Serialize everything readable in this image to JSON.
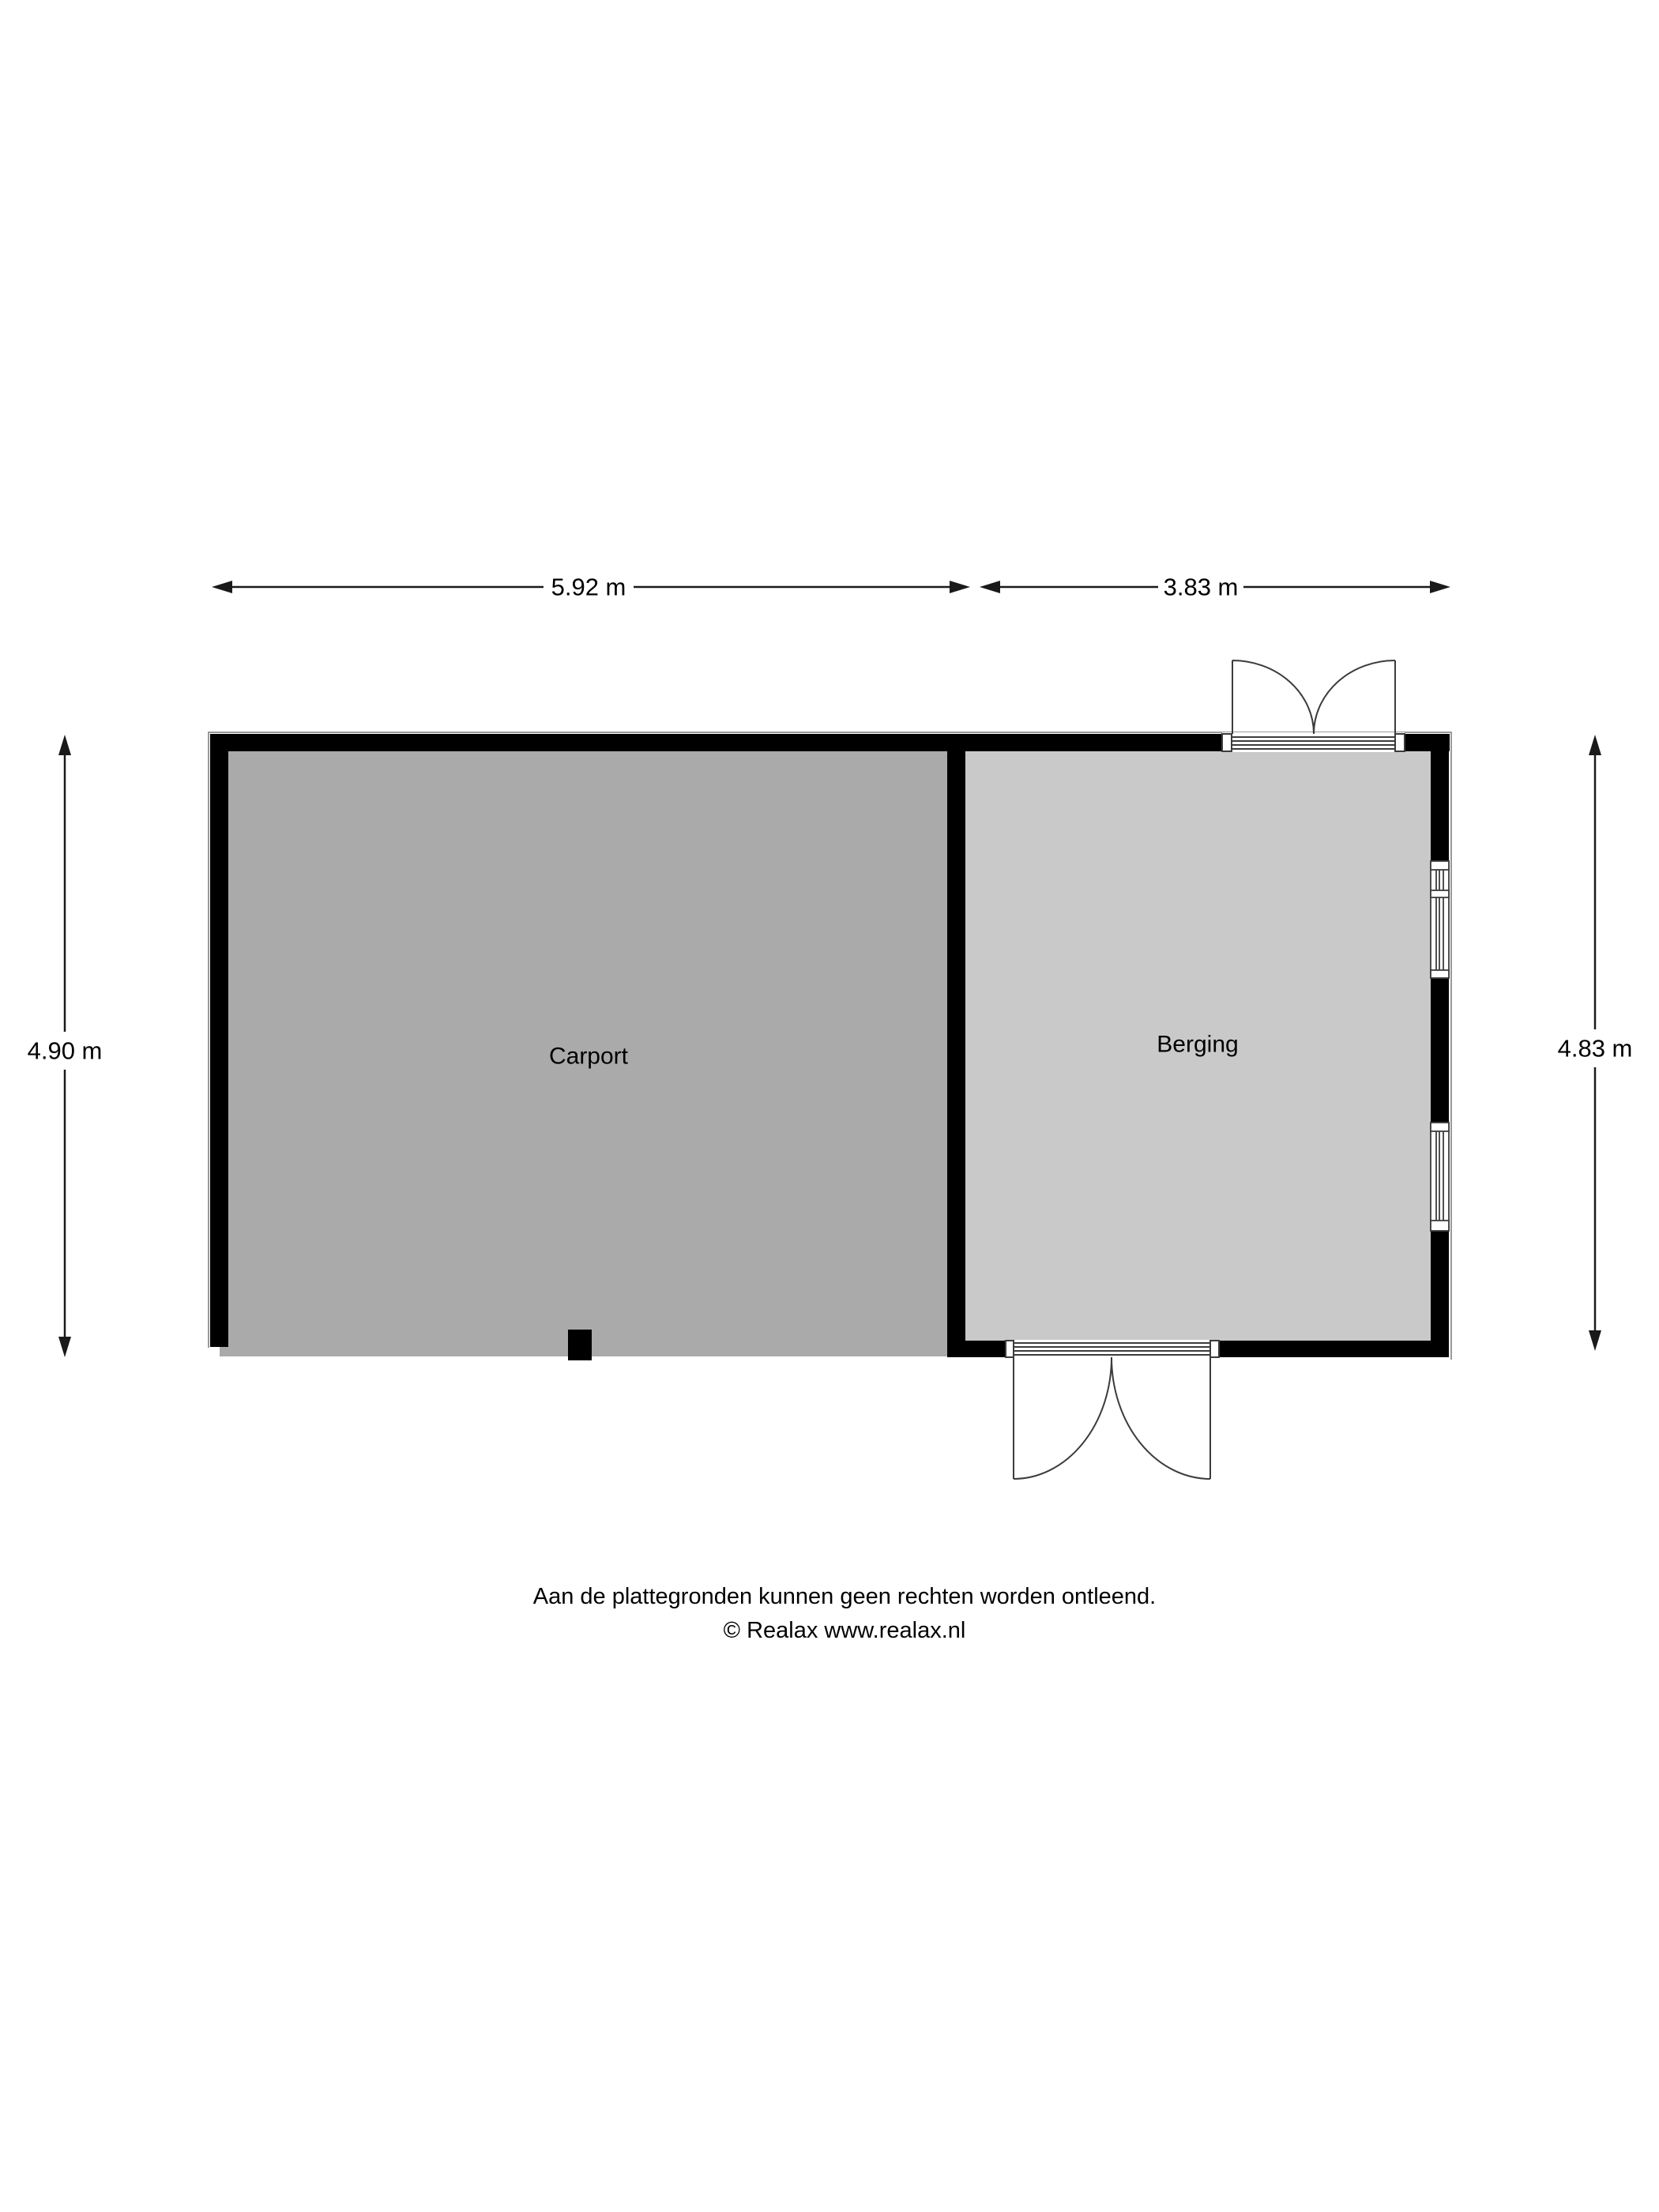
{
  "plan": {
    "rooms": [
      {
        "name": "Carport"
      },
      {
        "name": "Berging"
      }
    ],
    "dimensions": {
      "top_left": "5.92 m",
      "top_right": "3.83 m",
      "left": "4.90 m",
      "right": "4.83 m"
    },
    "footer": {
      "disclaimer": "Aan de plattegronden kunnen geen rechten worden ontleend.",
      "copyright": "© Realax www.realax.nl"
    },
    "colors": {
      "wall": "#000000",
      "carport_floor": "#aaaaaa",
      "berging_floor": "#c9c9c9",
      "outline": "#999999",
      "symbol_line": "#3c3c3c",
      "dimension_line": "#1a1a1a",
      "background": "#ffffff"
    }
  }
}
